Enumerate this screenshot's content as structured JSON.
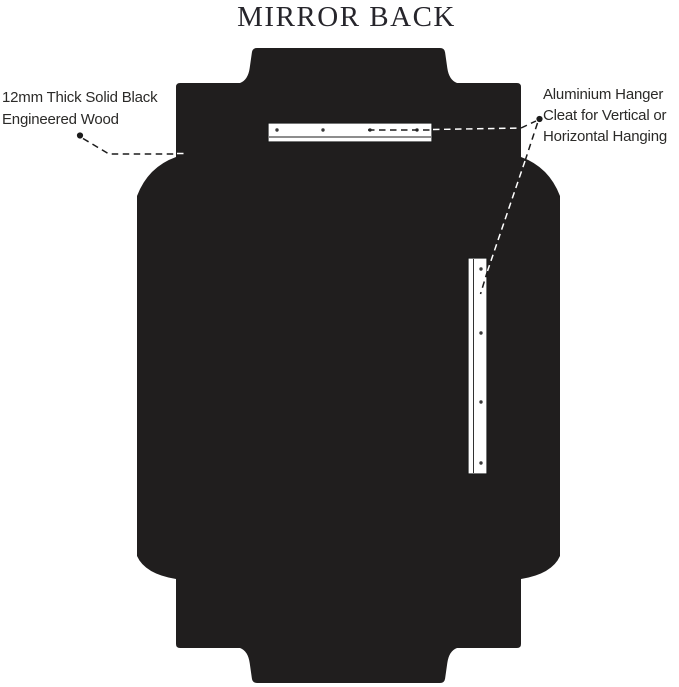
{
  "title": "MIRROR BACK",
  "labels": {
    "wood": {
      "lines": [
        "12mm Thick Solid Black",
        "Engineered Wood"
      ]
    },
    "hanger": {
      "lines": [
        "Aluminium Hanger",
        "Cleat for Vertical or",
        "Horizontal Hanging"
      ]
    }
  },
  "colors": {
    "background": "#ffffff",
    "panel_fill": "#201e1e",
    "cleat_fill": "#ffffff",
    "cleat_stroke": "#1b1b1b",
    "screw_dot": "#3a3a3a",
    "leader_on_white": "#1b1b1b",
    "leader_on_black": "#ffffff",
    "title_text": "#26252b",
    "label_text": "#2b2a28"
  }
}
